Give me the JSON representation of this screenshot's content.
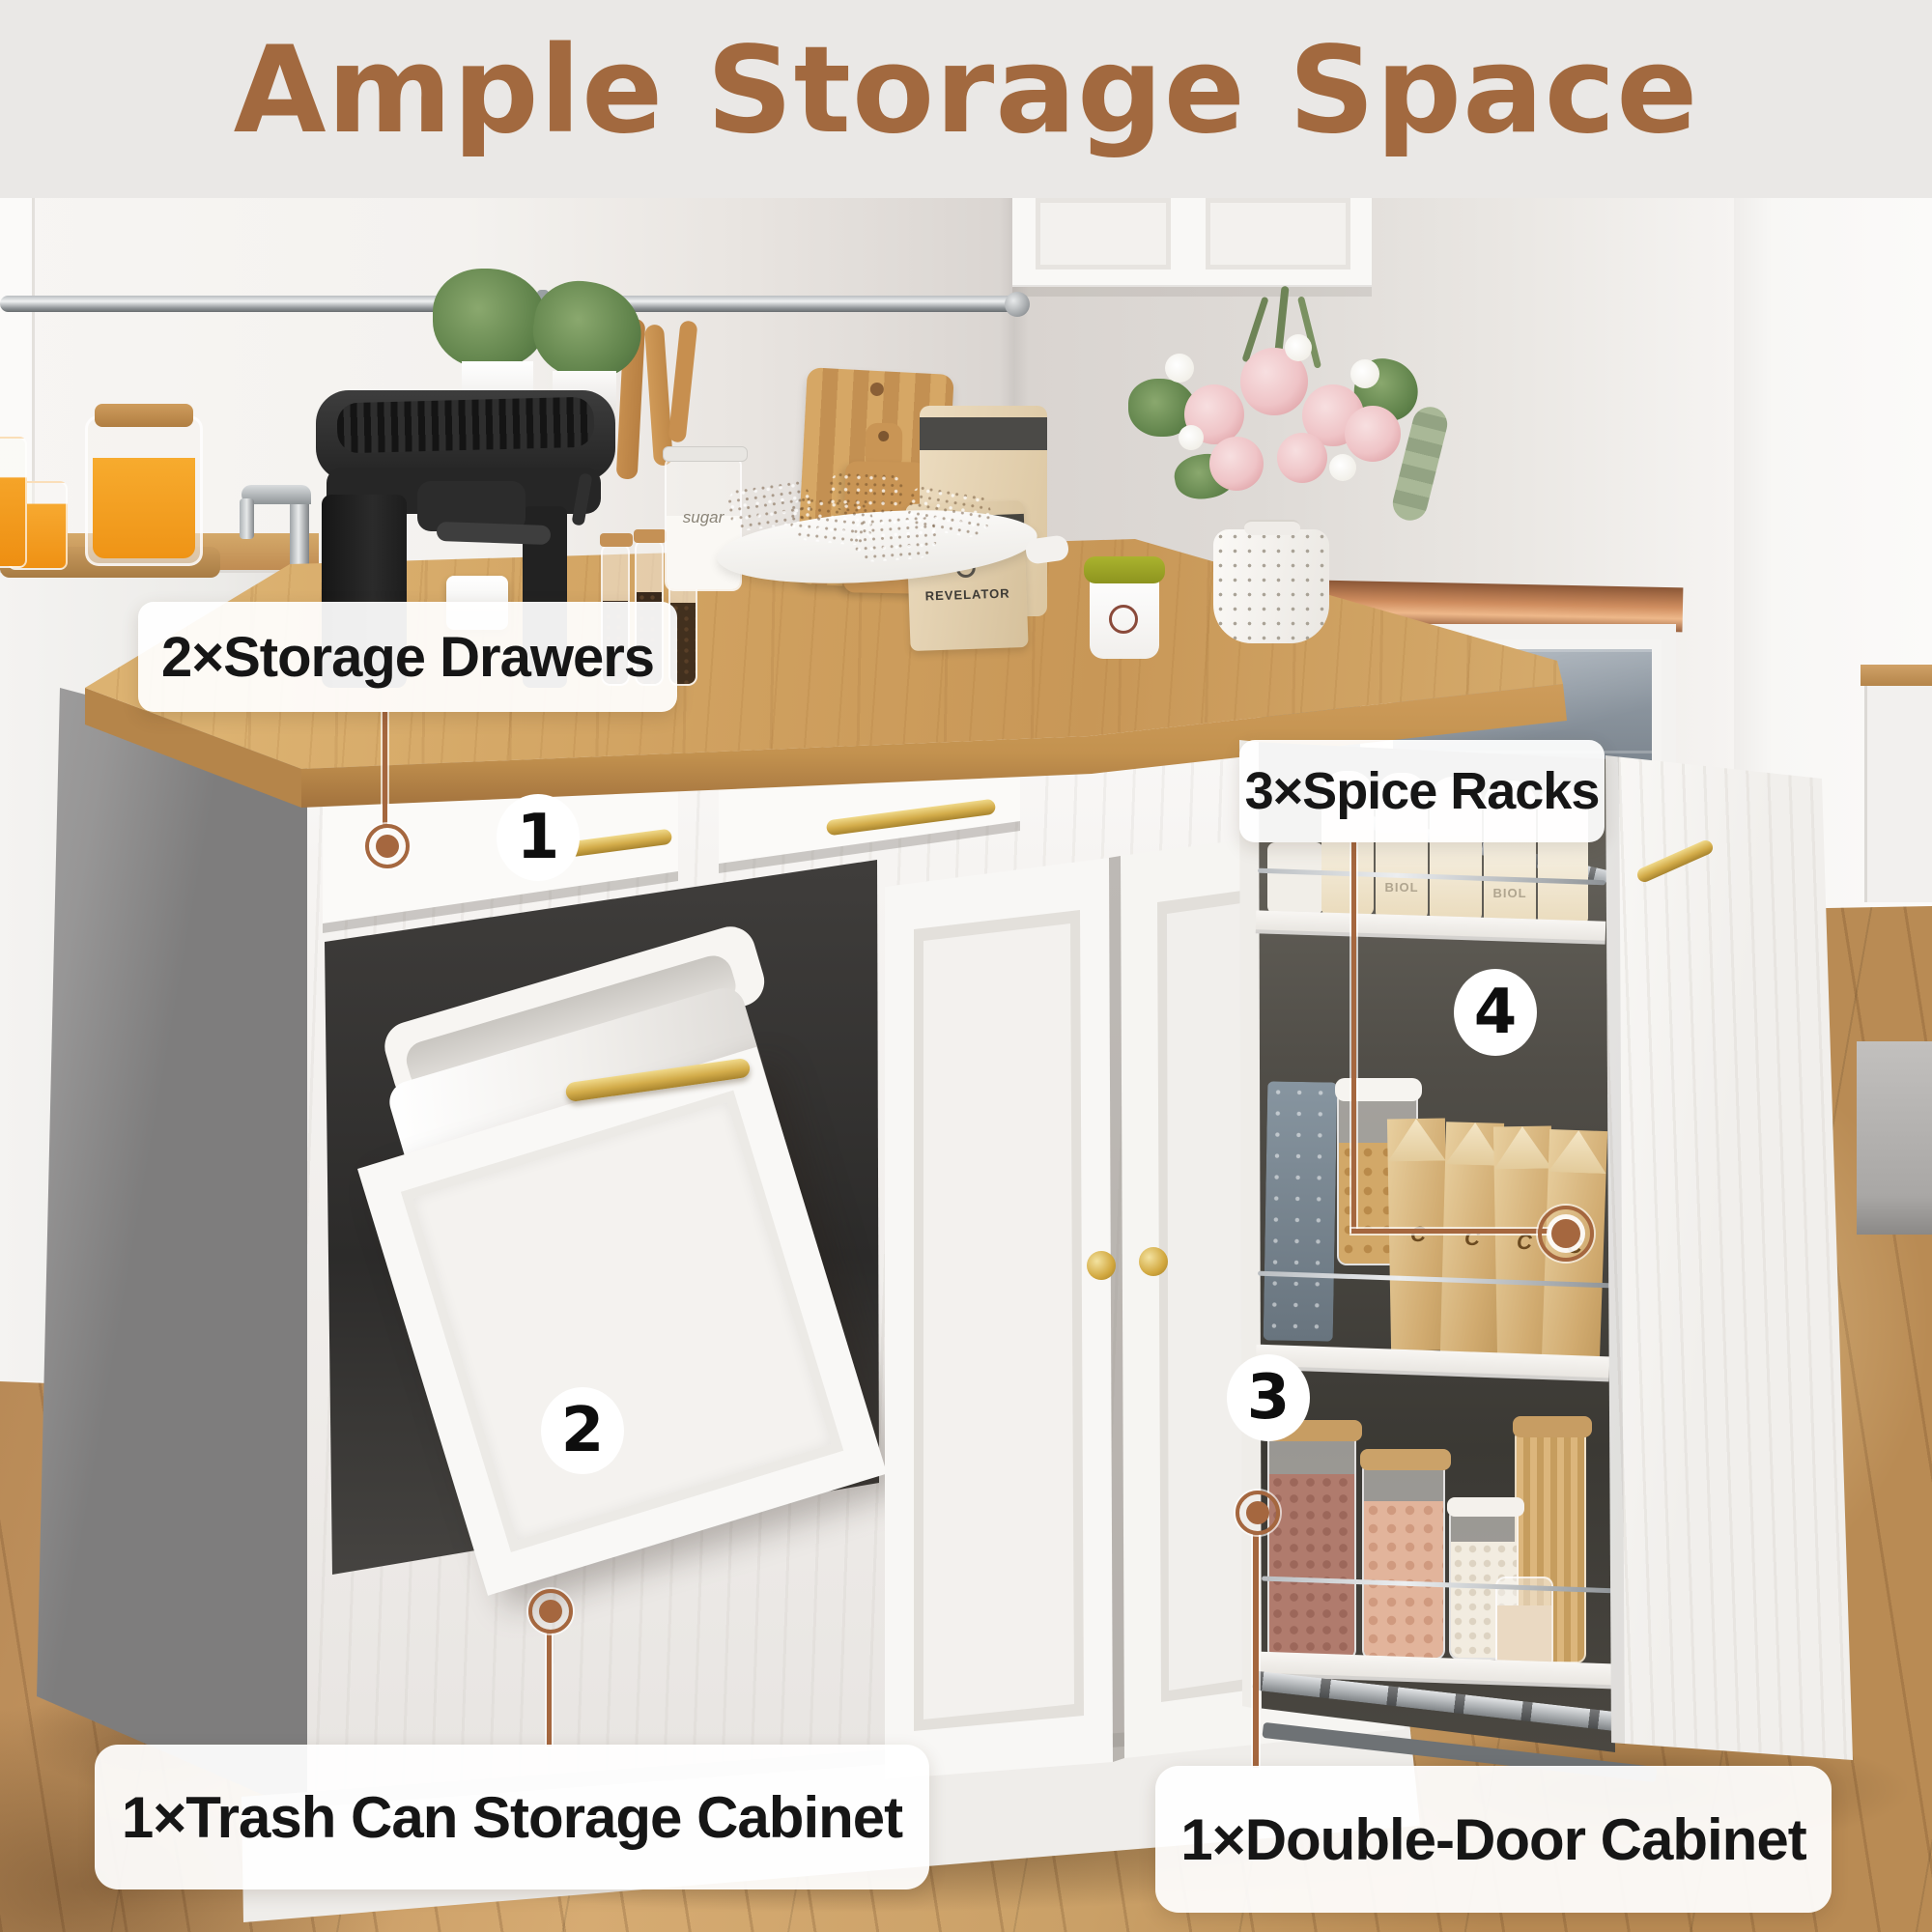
{
  "title": {
    "text": "Ample Storage Space"
  },
  "callouts": [
    {
      "name": "storage-drawers",
      "label": "2×Storage Drawers",
      "badge": "1"
    },
    {
      "name": "trash-can-storage-cabinet",
      "label": "1×Trash Can Storage Cabinet",
      "badge": "2"
    },
    {
      "name": "double-door-cabinet",
      "label": "1×Double-Door Cabinet",
      "badge": "3"
    },
    {
      "name": "spice-racks",
      "label": "3×Spice Racks",
      "badge": "4"
    }
  ],
  "photo_text": {
    "coffee_bag_brand": "REVELATOR",
    "sugar_jar_label": "sugar",
    "bottle_brand": "BIOL"
  },
  "colors": {
    "title_color": "#A2693F",
    "accent": "#A5673F",
    "label_bg": "#FFFFFF",
    "label_text": "#161616",
    "badge_bg": "#FFFFFF",
    "badge_text": "#0E0E0E",
    "gold": "#D4AC4E",
    "countertop_wood": "#CFA05F",
    "floor_wood": "#C2935E"
  }
}
